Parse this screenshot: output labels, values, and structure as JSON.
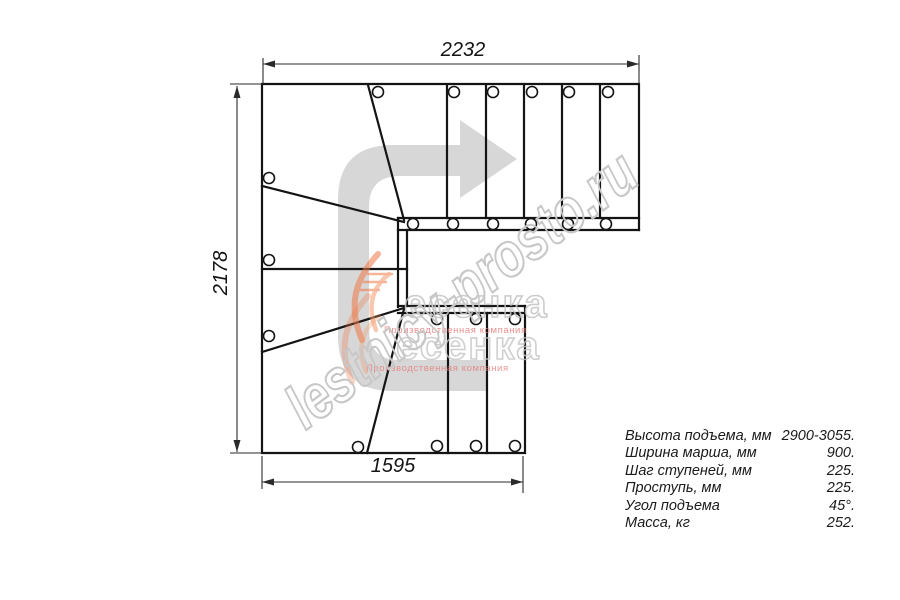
{
  "drawing": {
    "type": "staircase-plan-view",
    "dimensions": {
      "top": "2232",
      "left": "2178",
      "bottom": "1595"
    },
    "direction_arrow": "u-turn-direction-arrow-pointing-right",
    "line_color": "#141414",
    "arrow_color": "#d7d7d7"
  },
  "watermark": {
    "site": "lestnicy-prosto.ru",
    "brand": "есенка",
    "tagline": "Производственная компания",
    "outline_gray": "#c7c7c7",
    "tagline_red": "#e57b7b",
    "flame_orange": "#ee7948"
  },
  "spec_table": {
    "rows": [
      {
        "label": "Высота подъема, мм",
        "value": "2900-3055."
      },
      {
        "label": "Ширина марша, мм",
        "value": "900."
      },
      {
        "label": "Шаг ступеней, мм",
        "value": "225."
      },
      {
        "label": "Проступь, мм",
        "value": "225."
      },
      {
        "label": "Угол подъема",
        "value": "45°."
      },
      {
        "label": "Масса, кг",
        "value": "252."
      }
    ]
  }
}
